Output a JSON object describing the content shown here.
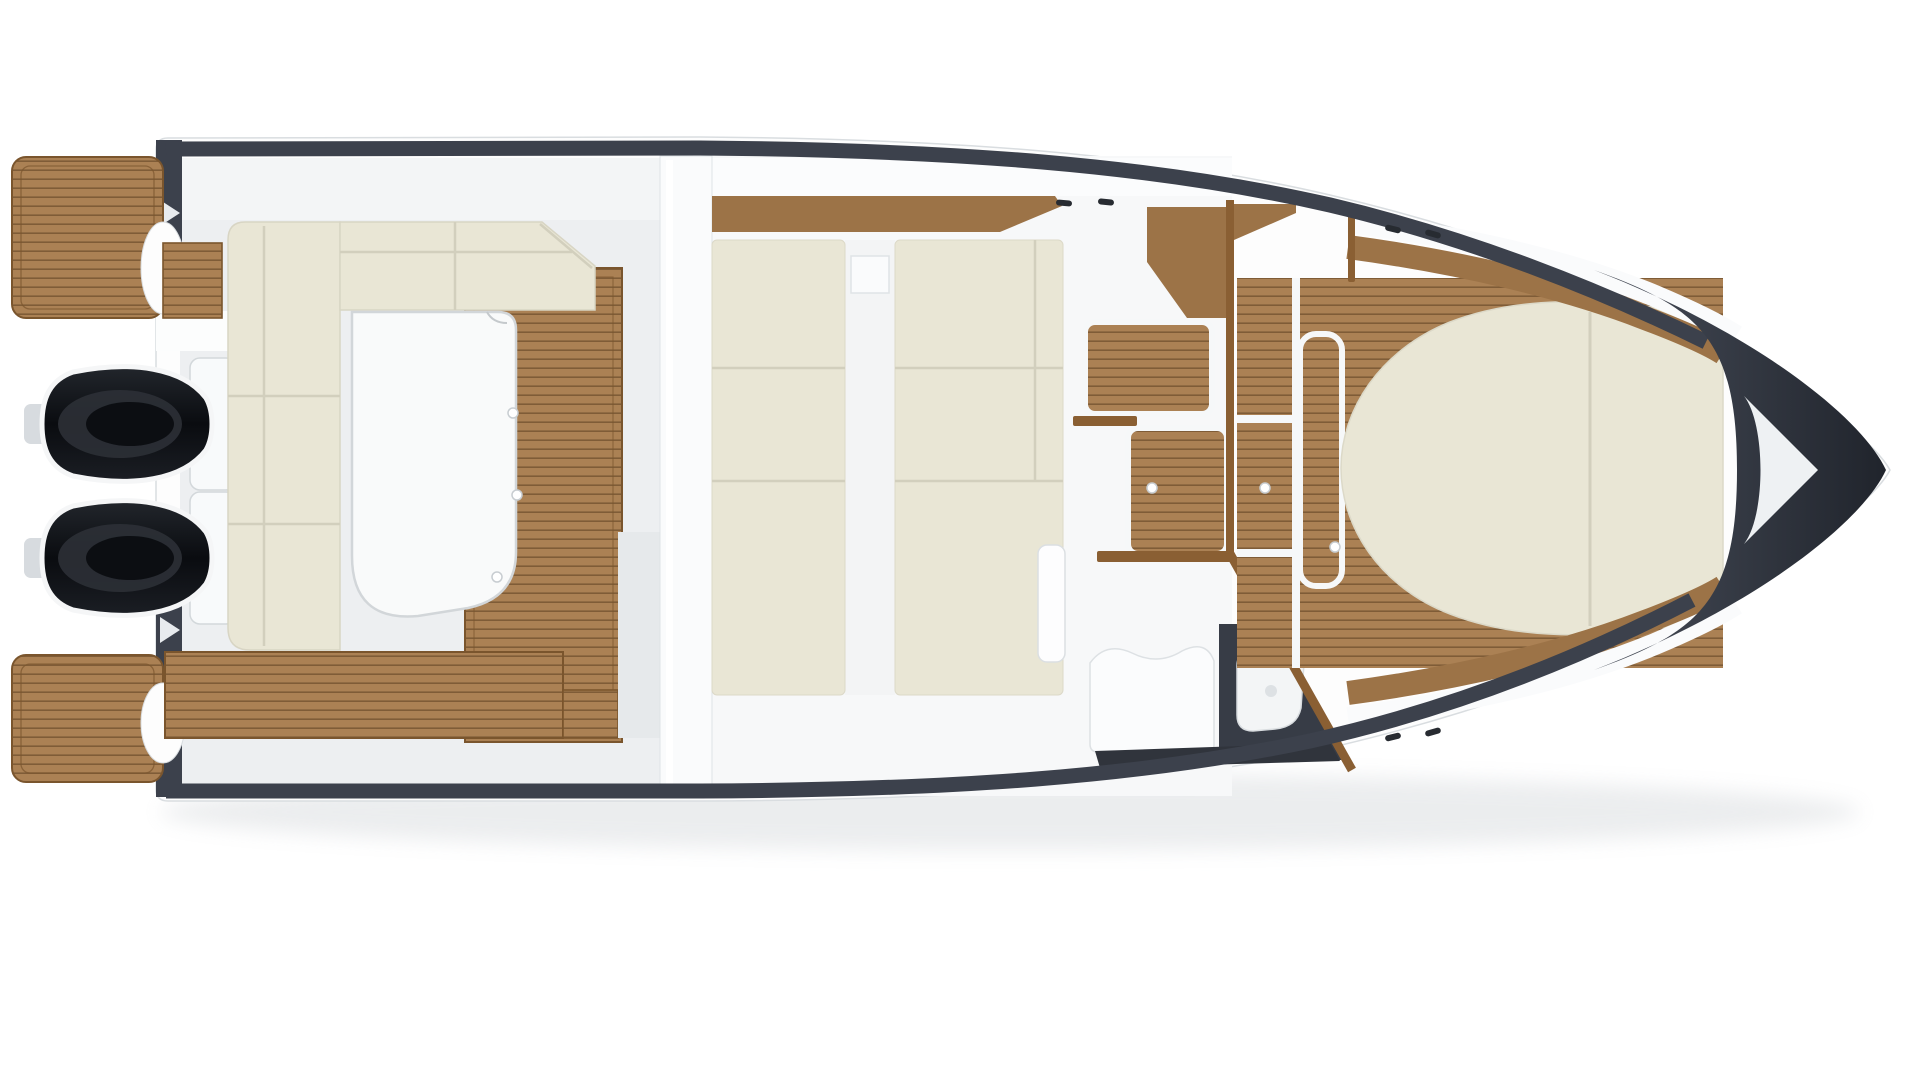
{
  "page": {
    "description": "Top-view deck plan of a motor boat with twin outboard engines, bow pointing right",
    "background": "#ffffff"
  },
  "boat": {
    "orientation": {
      "bow": "right",
      "stern": "left"
    },
    "counts": {
      "outboard_engines": 2,
      "swim_platforms": 2,
      "cabin_berths": 2,
      "mooring_cleats": 6,
      "teak_deck_dots": 5
    },
    "labels": {
      "shadow": "Hull drop shadow",
      "hull": "Hull (top view)",
      "transom": "Transom",
      "transom_trim": "Transom dark trim",
      "walkthrough": "Transom walkthrough",
      "swim_platform_port": "Teak swim platform (port)",
      "swim_platform_starboard": "Teak swim platform (starboard)",
      "stern_step": "Teak transom step",
      "engine_port": "Outboard engine (port)",
      "engine_starboard": "Outboard engine (starboard)",
      "cockpit_floor": "Teak cockpit sole",
      "aft_bench": "Aft teak bench",
      "settee": "L-shaped cockpit settee",
      "table": "Cockpit table",
      "bulkhead": "Cabin bulkhead",
      "companionway_step": "Companionway step",
      "cabin_trim": "Cabin side wood trim",
      "berth_aft": "Cabin berth cushion (aft)",
      "berth_forward": "Cabin berth cushion (forward)",
      "aisle": "Cabin center aisle",
      "cabin_door": "Cabin locker door",
      "helm_step_upper": "Teak helm step (upper)",
      "helm_step_lower": "Teak helm step (lower)",
      "helm_trim": "Helm wood trim",
      "console": "Console wood panel",
      "windshield": "Windshield frame",
      "windshield_diagonal": "Windshield side frame",
      "helm_seat": "Helm seat module",
      "side_locker": "Side boarding locker",
      "sink": "Sink basin",
      "side_trim_strip": "Gunwale trim strip",
      "foredeck": "Teak foredeck panels",
      "deck_hatch": "Foredeck hatch",
      "sun_pad": "Bow sun pad",
      "side_deck_port": "Teak side deck (port)",
      "side_deck_starboard": "Teak side deck (starboard)",
      "grab_rail": "Bow grab rail post",
      "gunwale_top": "Gunwale rub rail (port)",
      "gunwale_bottom": "Gunwale rub rail (starboard)",
      "bow_cap": "Anthracite bow cap",
      "anchor_hatch": "Anchor locker hatch",
      "cleats": "Mooring cleats",
      "deck_dots": "Deck hardware fittings"
    }
  },
  "palette": {
    "teak": "#ab8154",
    "teak_line": "#5b3d1e",
    "teak_frame": "#7a552d",
    "wood_trim": "#9c7347",
    "windshield_wood": "#8a5f33",
    "cushion": "#e9e6d5",
    "cushion_seam": "#d2cfbd",
    "hull_white": "#fdfdfd",
    "deck_gray": "#edeff1",
    "deck_light": "#f6f8f9",
    "dark_trim": "#3c414c",
    "bow_cap_dark": "#272b33",
    "engine_black": "#101217",
    "table_white": "#f9fafa",
    "strip_black": "#30343c"
  }
}
